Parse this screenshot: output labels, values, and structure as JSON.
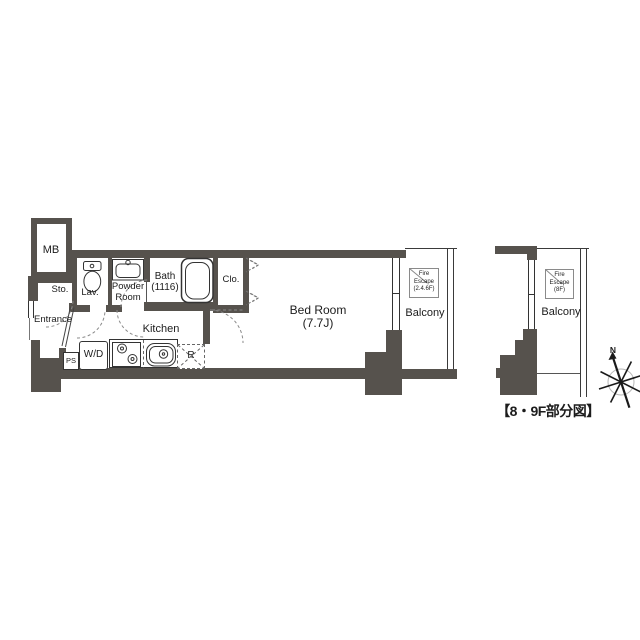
{
  "labels": {
    "mb": "MB",
    "sto": "Sto.",
    "lav": "Lav.",
    "powder_room": "Powder\nRoom",
    "bath": "Bath\n(1116)",
    "clo": "Clo.",
    "entrance": "Entrance",
    "ps": "PS",
    "wd": "W/D",
    "kitchen": "Kitchen",
    "fridge": "R",
    "bedroom": "Bed Room\n(7.7J)",
    "balcony": "Balcony",
    "fire_escape": "Fire\nEscape\n(2.4.6F)"
  },
  "partial_figure": {
    "balcony": "Balcony",
    "fire_escape": "Fire\nEscape\n(8F)",
    "caption": "【8・9F部分図】"
  },
  "compass": {
    "north": "N"
  },
  "colors": {
    "wall": "#56524d",
    "line": "#333333",
    "dashed": "#8a8a8a",
    "text": "#1c1c1c"
  }
}
